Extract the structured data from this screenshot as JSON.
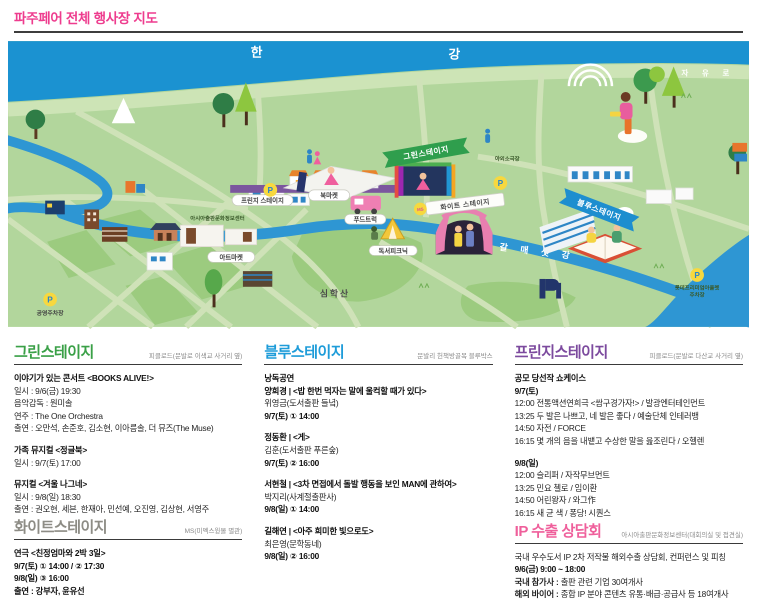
{
  "page": {
    "title": "파주페어 전체 행사장 지도"
  },
  "colors": {
    "title": "#ee3c8e",
    "green": "#3aa047",
    "blue": "#1e9cd9",
    "fringe": "#7c4a9e",
    "white": "#8d8c85",
    "ip": "#ef5f9b"
  },
  "map": {
    "han_river_1": "한",
    "han_river_2": "강",
    "road": "자 유 로",
    "stream": "갈매샛강",
    "mountain": "심학산",
    "parking": "P",
    "green_banner": "그린스테이지",
    "fringe_label": "프린지 스테이지",
    "white_banner": "화이트 스테이지",
    "white_badge": "MS",
    "blue_ribbon": "블루스테이지",
    "book_market": "북마켓",
    "art_market": "아트마켓",
    "food_truck": "푸드트럭",
    "book_picnic": "독서피크닉",
    "asia_center": "아시아출판문화정보센터",
    "outdoor_theater": "야외소극장",
    "public_parking": "공영주차장",
    "outlet_parking_1": "롯데프리미엄아울렛",
    "outlet_parking_2": "주차장"
  },
  "sections": {
    "green": {
      "title": "그린스테이지",
      "location": "피클로드(문발로 이색교 사거리 옆)",
      "lines": [
        {
          "t": "이야기가 있는 콘서트 <BOOKS ALIVE!>"
        },
        {
          "t": "일시 : 9/6(금) 19:30"
        },
        {
          "t": "음악감독 : 원미솔"
        },
        {
          "t": "연주 : The One Orchestra"
        },
        {
          "t": "출연 : 오만석, 손준호, 김소현, 이아름솔, 더 뮤즈(The Muse)"
        },
        {
          "t": "가족 뮤지컬 <정글북>"
        },
        {
          "t": "일시 : 9/7(토) 17:00"
        },
        {
          "t": "뮤지컬 <겨울 나그네>"
        },
        {
          "t": "일시 : 9/8(일) 18:30"
        },
        {
          "t": "출연 : 권오현, 세븐, 한재아, 민선예, 오진영, 김상현, 서영주"
        }
      ]
    },
    "blue": {
      "title": "블루스테이지",
      "location": "문발리 헌책방골목 블루박스",
      "lines": [
        {
          "t": "낭독공연"
        },
        {
          "t": "양희경 | <밥 한번 먹자는 말에 울컥할 때가 있다>"
        },
        {
          "t": "위영금(도서출판 들녘)"
        },
        {
          "t": "9/7(토) ① 14:00"
        },
        {
          "t": "정동환 | <게>"
        },
        {
          "t": "김훈(도서출판 푸른숲)"
        },
        {
          "t": "9/7(토) ② 16:00"
        },
        {
          "t": "서현철 | <3차 면접에서 돌발 행동을 보인 MAN에 관하여>"
        },
        {
          "t": "박지리(사계절출판사)"
        },
        {
          "t": "9/8(일) ① 14:00"
        },
        {
          "t": "길해연 | <아주 희미한 빛으로도>"
        },
        {
          "t": "최은영(문학동네)"
        },
        {
          "t": "9/8(일) ② 16:00"
        }
      ]
    },
    "fringe": {
      "title": "프린지스테이지",
      "location": "피클로드(문발로 다산교 사거리 옆)",
      "lines": [
        {
          "t": "공모 당선작 쇼케이스"
        },
        {
          "t": "9/7(토)"
        },
        {
          "t": "12:00 전통액션연희극 <쌈구경가자!> / 발광엔터테인먼트"
        },
        {
          "t": "13:25 두 발은 나쁘고, 네 발은 좋다 / 예술단체 인테러뱅"
        },
        {
          "t": "14:50 자전 / FORCE"
        },
        {
          "t": "16:15 몇 개의 음을 내뱉고 수상한 말을 읊조린다 / 오헬렌"
        },
        {
          "t": "9/8(일)"
        },
        {
          "t": "12:00 슬리퍼 / 자작무브먼트"
        },
        {
          "t": "13:25 민요 첼로 / 임이환"
        },
        {
          "t": "14:50 어린왕자 / 와그作"
        },
        {
          "t": "16:15 새 균 색 / 퐁당! 시퀀스"
        }
      ]
    },
    "white": {
      "title": "화이트스테이지",
      "location": "MS(미멕스윙몰 별관)",
      "lines": [
        {
          "t": "연극 <친정엄마와 2박 3일>"
        },
        {
          "t": "9/7(토) ① 14:00 / ② 17:30"
        },
        {
          "t": "9/8(일) ③ 16:00"
        },
        {
          "t": "출연 : 강부자, 윤유선"
        }
      ]
    },
    "ip": {
      "title": "IP 수출 상담회",
      "location": "아시아출판문화정보센터(대회의실 및 접견실)",
      "intro": "국내 우수도서 IP 2차 저작물 해외수출 상담회, 컨퍼런스 및 피칭",
      "time": "9/6(금) 9:00 ~ 18:00",
      "domestic_label": "국내 참가사 : ",
      "domestic": "출판 관련 기업 30여개사",
      "overseas_label": "해외 바이어 : ",
      "overseas": "종합 IP 분야 콘텐츠 유통·배급·공급사 등 18여개사"
    }
  }
}
